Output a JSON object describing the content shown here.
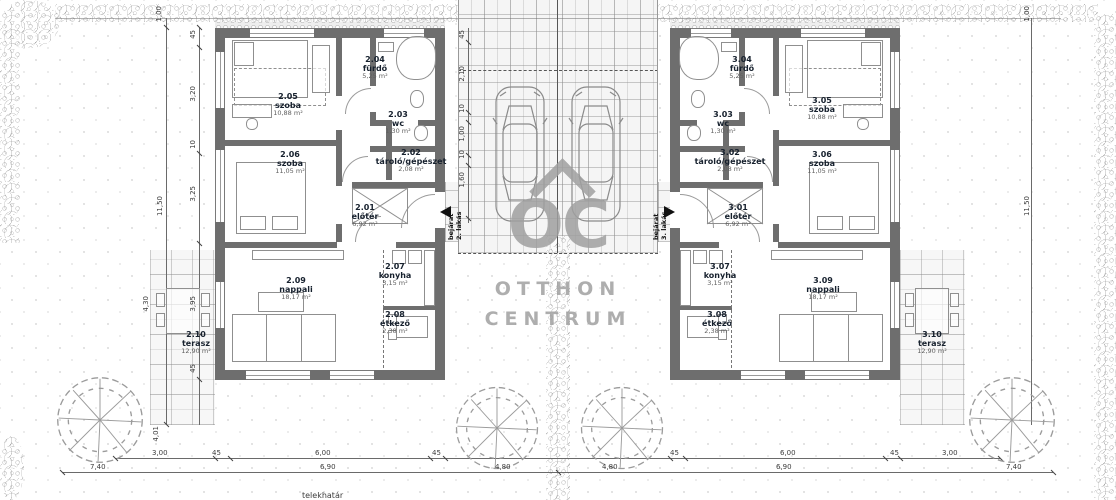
{
  "watermark": {
    "logo": "OC",
    "line1": "OTTHON",
    "line2": "CENTRUM"
  },
  "site": {
    "boundary_label": "telekhatár"
  },
  "entrances": {
    "left": [
      "bejárat",
      "2. lakás"
    ],
    "right": [
      "bejárat",
      "3. lakás"
    ]
  },
  "units": [
    {
      "name": "2. lakás",
      "rooms": [
        {
          "number": "2.01",
          "name": "előtér",
          "area": "6,92 m²"
        },
        {
          "number": "2.02",
          "name": "tároló/gépészet",
          "area": "2,08 m²"
        },
        {
          "number": "2.03",
          "name": "wc",
          "area": "1,30 m²"
        },
        {
          "number": "2.04",
          "name": "fürdő",
          "area": "5,25 m²"
        },
        {
          "number": "2.05",
          "name": "szoba",
          "area": "10,88 m²"
        },
        {
          "number": "2.06",
          "name": "szoba",
          "area": "11,05 m²"
        },
        {
          "number": "2.07",
          "name": "konyha",
          "area": "3,15 m²"
        },
        {
          "number": "2.08",
          "name": "étkező",
          "area": "2,38 m²"
        },
        {
          "number": "2.09",
          "name": "nappali",
          "area": "18,17 m²"
        },
        {
          "number": "2.10",
          "name": "terasz",
          "area": "12,90 m²"
        }
      ]
    },
    {
      "name": "3. lakás",
      "rooms": [
        {
          "number": "3.01",
          "name": "előtér",
          "area": "6,92 m²"
        },
        {
          "number": "3.02",
          "name": "tároló/gépészet",
          "area": "2,08 m²"
        },
        {
          "number": "3.03",
          "name": "wc",
          "area": "1,30 m²"
        },
        {
          "number": "3.04",
          "name": "fürdő",
          "area": "5,25 m²"
        },
        {
          "number": "3.05",
          "name": "szoba",
          "area": "10,88 m²"
        },
        {
          "number": "3.06",
          "name": "szoba",
          "area": "11,05 m²"
        },
        {
          "number": "3.07",
          "name": "konyha",
          "area": "3,15 m²"
        },
        {
          "number": "3.08",
          "name": "étkező",
          "area": "2,38 m²"
        },
        {
          "number": "3.09",
          "name": "nappali",
          "area": "18,17 m²"
        },
        {
          "number": "3.10",
          "name": "terasz",
          "area": "12,90 m²"
        }
      ]
    }
  ],
  "dimensions": {
    "left": [
      "1,00",
      "45",
      "3,20",
      "10",
      "3,25",
      "11,50",
      "4,30",
      "3,95",
      "45",
      "4,01"
    ],
    "right": [
      "1,00",
      "11,50"
    ],
    "bottom_upper": [
      "3,00",
      "45",
      "6,00",
      "45",
      "45",
      "6,00",
      "45",
      "3,00"
    ],
    "bottom_lower": [
      "7,40",
      "6,90",
      "4,80",
      "4,80",
      "6,90",
      "7,40"
    ],
    "driveway": [
      "45",
      "2,10",
      "10",
      "1,00",
      "10",
      "1,60"
    ]
  }
}
